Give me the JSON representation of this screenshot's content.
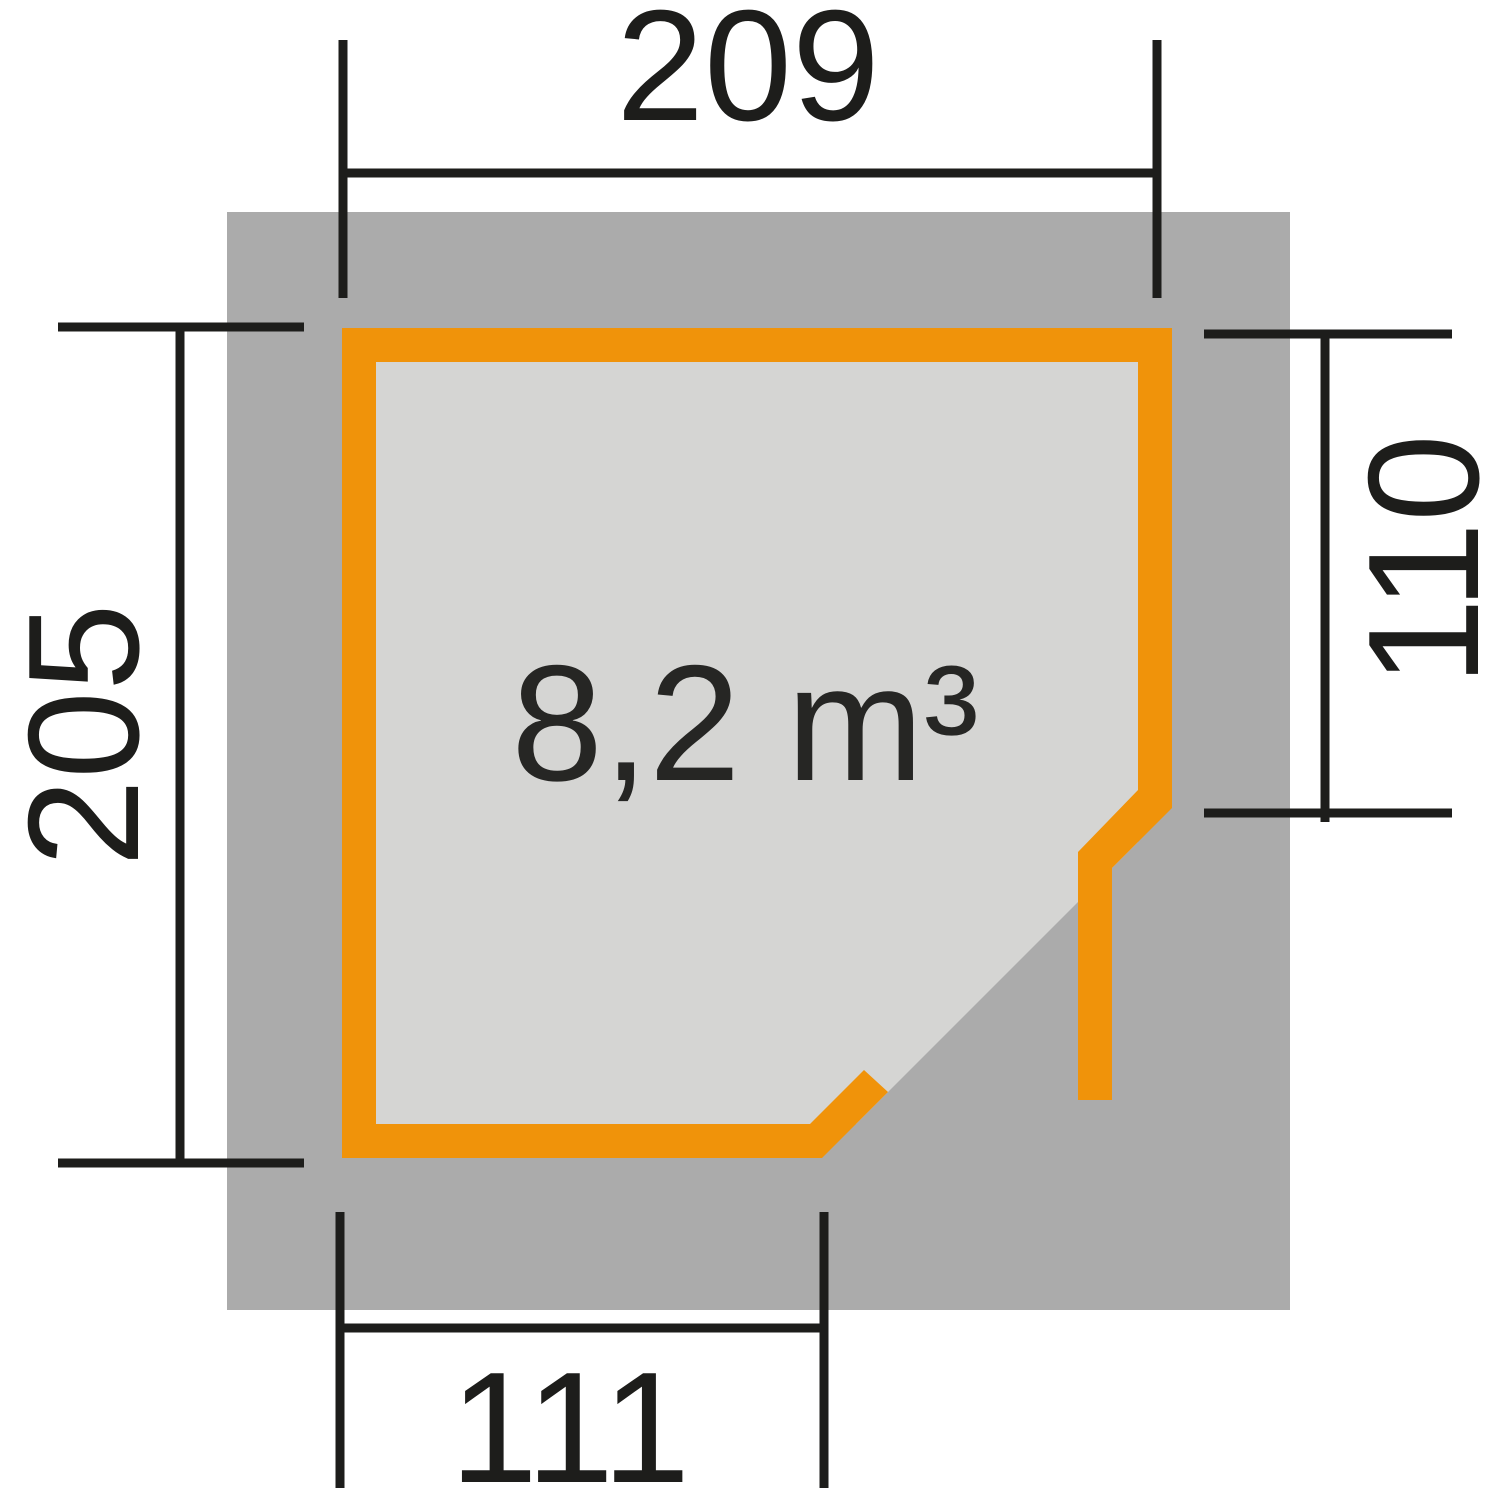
{
  "plan": {
    "volume_label": "8,2 m³",
    "dimensions": {
      "top": "209",
      "left": "205",
      "right": "110",
      "bottom": "111"
    },
    "colors": {
      "wall_accent_orange": "#F0930A",
      "roof_footprint_gray": "#ABABAB",
      "floor_area_gray": "#D5D5D3",
      "dimension_line_black": "#1D1D1B",
      "background_white": "#FFFFFF"
    }
  }
}
